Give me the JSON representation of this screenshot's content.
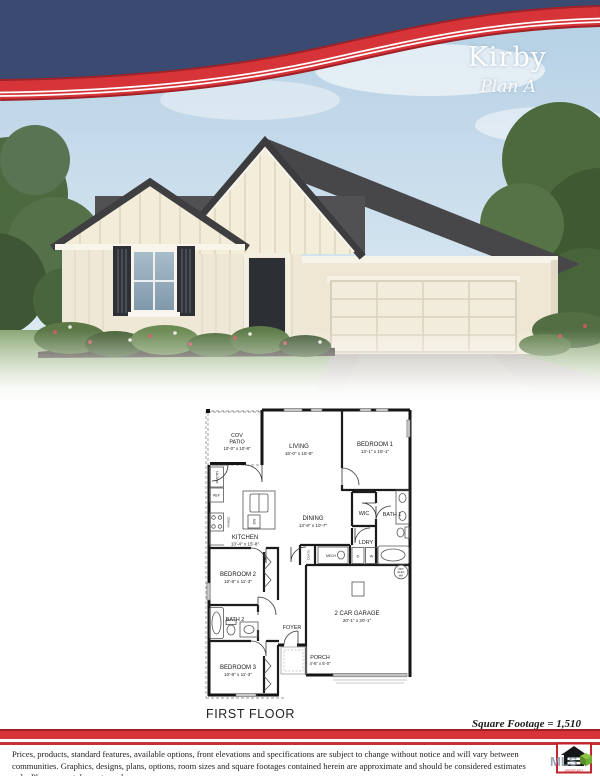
{
  "header": {
    "plan_name": "Kirby",
    "plan_variant": "Plan A"
  },
  "colors": {
    "brand_blue": "#3b4a70",
    "brand_red": "#d7343a",
    "siding_cream": "#efe8d6",
    "roof_gray": "#48484a"
  },
  "floor_plan": {
    "title": "FIRST FLOOR",
    "square_footage_label": "Square Footage = 1,510",
    "rooms": {
      "cov_patio": {
        "l1": "COV",
        "l2": "PATIO",
        "dims": "10'-0\" x 10'-8\""
      },
      "living": {
        "name": "LIVING",
        "dims": "15'-0\" x 15'-9\""
      },
      "bedroom1": {
        "name": "BEDROOM 1",
        "dims": "13'-1\" x 15'-1\""
      },
      "kitchen": {
        "name": "KITCHEN",
        "dims": "13'-4\" x 15'-8\""
      },
      "dining": {
        "name": "DINING",
        "dims": "13'-8\" x 10'-7\""
      },
      "wic": {
        "name": "WIC"
      },
      "bath1": {
        "name": "BATH 1"
      },
      "ldry": {
        "name": "LDRY"
      },
      "bedroom2": {
        "name": "BEDROOM 2",
        "dims": "10'-8\" x 11'-3\""
      },
      "bath2": {
        "name": "BATH 2"
      },
      "foyer": {
        "name": "FOYER"
      },
      "bedroom3": {
        "name": "BEDROOM 3",
        "dims": "10'-8\" x 11'-3\""
      },
      "garage": {
        "name": "2 CAR GARAGE",
        "dims": "20'-1\" x 20'-1\""
      },
      "porch": {
        "name": "PORCH",
        "dims": "4'-6\" x 5'-0\""
      }
    },
    "fixtures": {
      "pantry": "PANTRY",
      "ref": "REF",
      "range": "RANGE",
      "dw": "DW",
      "coats": "COATS",
      "mech": "MECH",
      "dryer": "D",
      "washer": "W",
      "opt_wh": {
        "l1": "OPT",
        "l2": "ELEC",
        "l3": "WH"
      }
    }
  },
  "footer": {
    "disclaimer_line1": "Prices, products, standard features, available options, front elevations and specifications are subject to change without notice and will vary between communities.  Graphics, designs,",
    "disclaimer_line2": "plans, options, room sizes and square footages contained herein are approximate and should be considered estimates only.  Plans are not drawn to scale.",
    "logo": {
      "mls_text": "MLS",
      "equal_housing_text": "OPPORTUNITY"
    }
  }
}
